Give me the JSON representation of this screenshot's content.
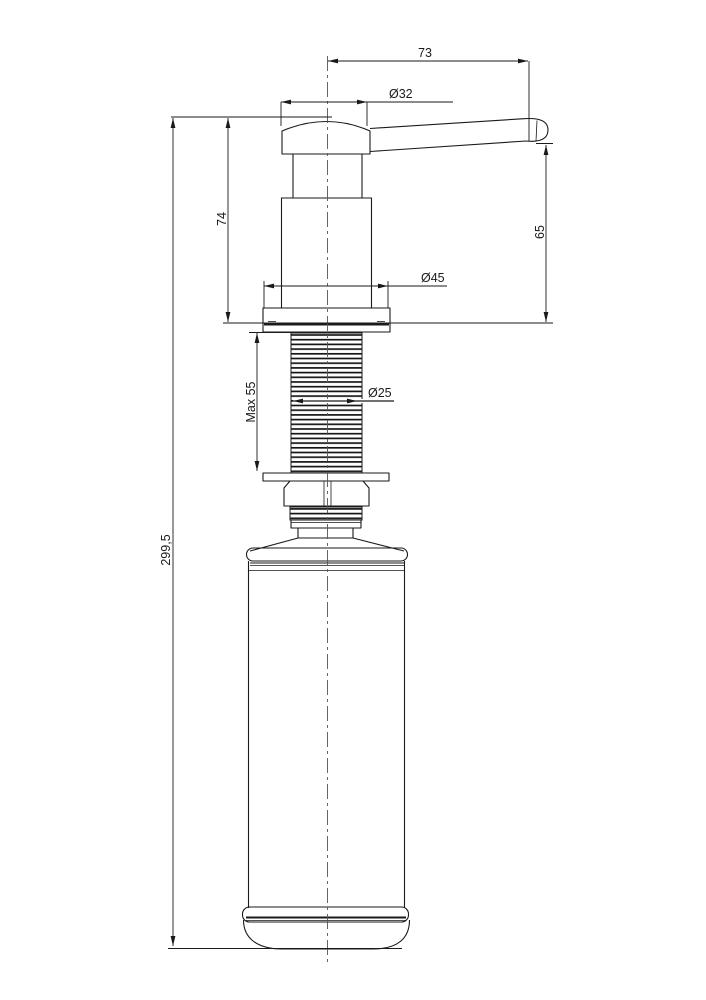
{
  "drawing": {
    "background": "#ffffff",
    "line_color": "#1a1a1a",
    "dimensions": {
      "spout_reach": "73",
      "knob_diameter": "Ø32",
      "head_height": "74",
      "spout_clearance": "65",
      "flange_diameter": "Ø45",
      "max_mounting_thickness": "Max 55",
      "thread_diameter": "Ø25",
      "overall_height": "299,5"
    }
  }
}
